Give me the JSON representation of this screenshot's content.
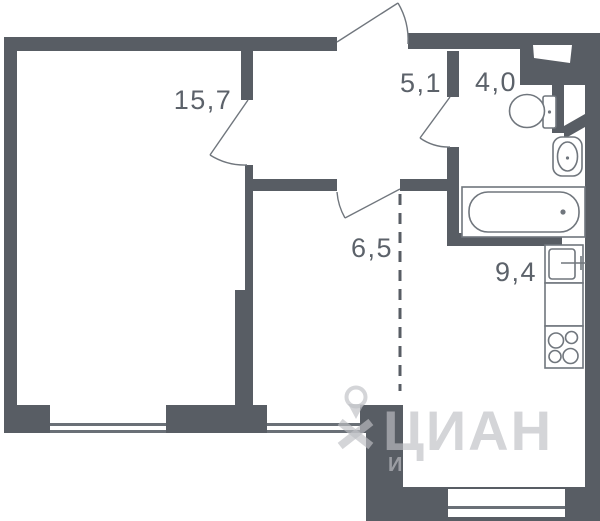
{
  "plan": {
    "rooms": [
      {
        "name": "living-room",
        "area": "15,7"
      },
      {
        "name": "hallway",
        "area": "5,1"
      },
      {
        "name": "bathroom",
        "area": "4,0"
      },
      {
        "name": "inner-room",
        "area": "6,5"
      },
      {
        "name": "kitchen",
        "area": "9,4"
      }
    ]
  },
  "watermark": {
    "brand": "ЦИАН",
    "partial_line2": "И"
  },
  "colors": {
    "wall": "#585d64",
    "fixture_line": "#70767d",
    "label_text": "#5c626a",
    "watermark": "rgba(190,192,196,0.66)"
  }
}
